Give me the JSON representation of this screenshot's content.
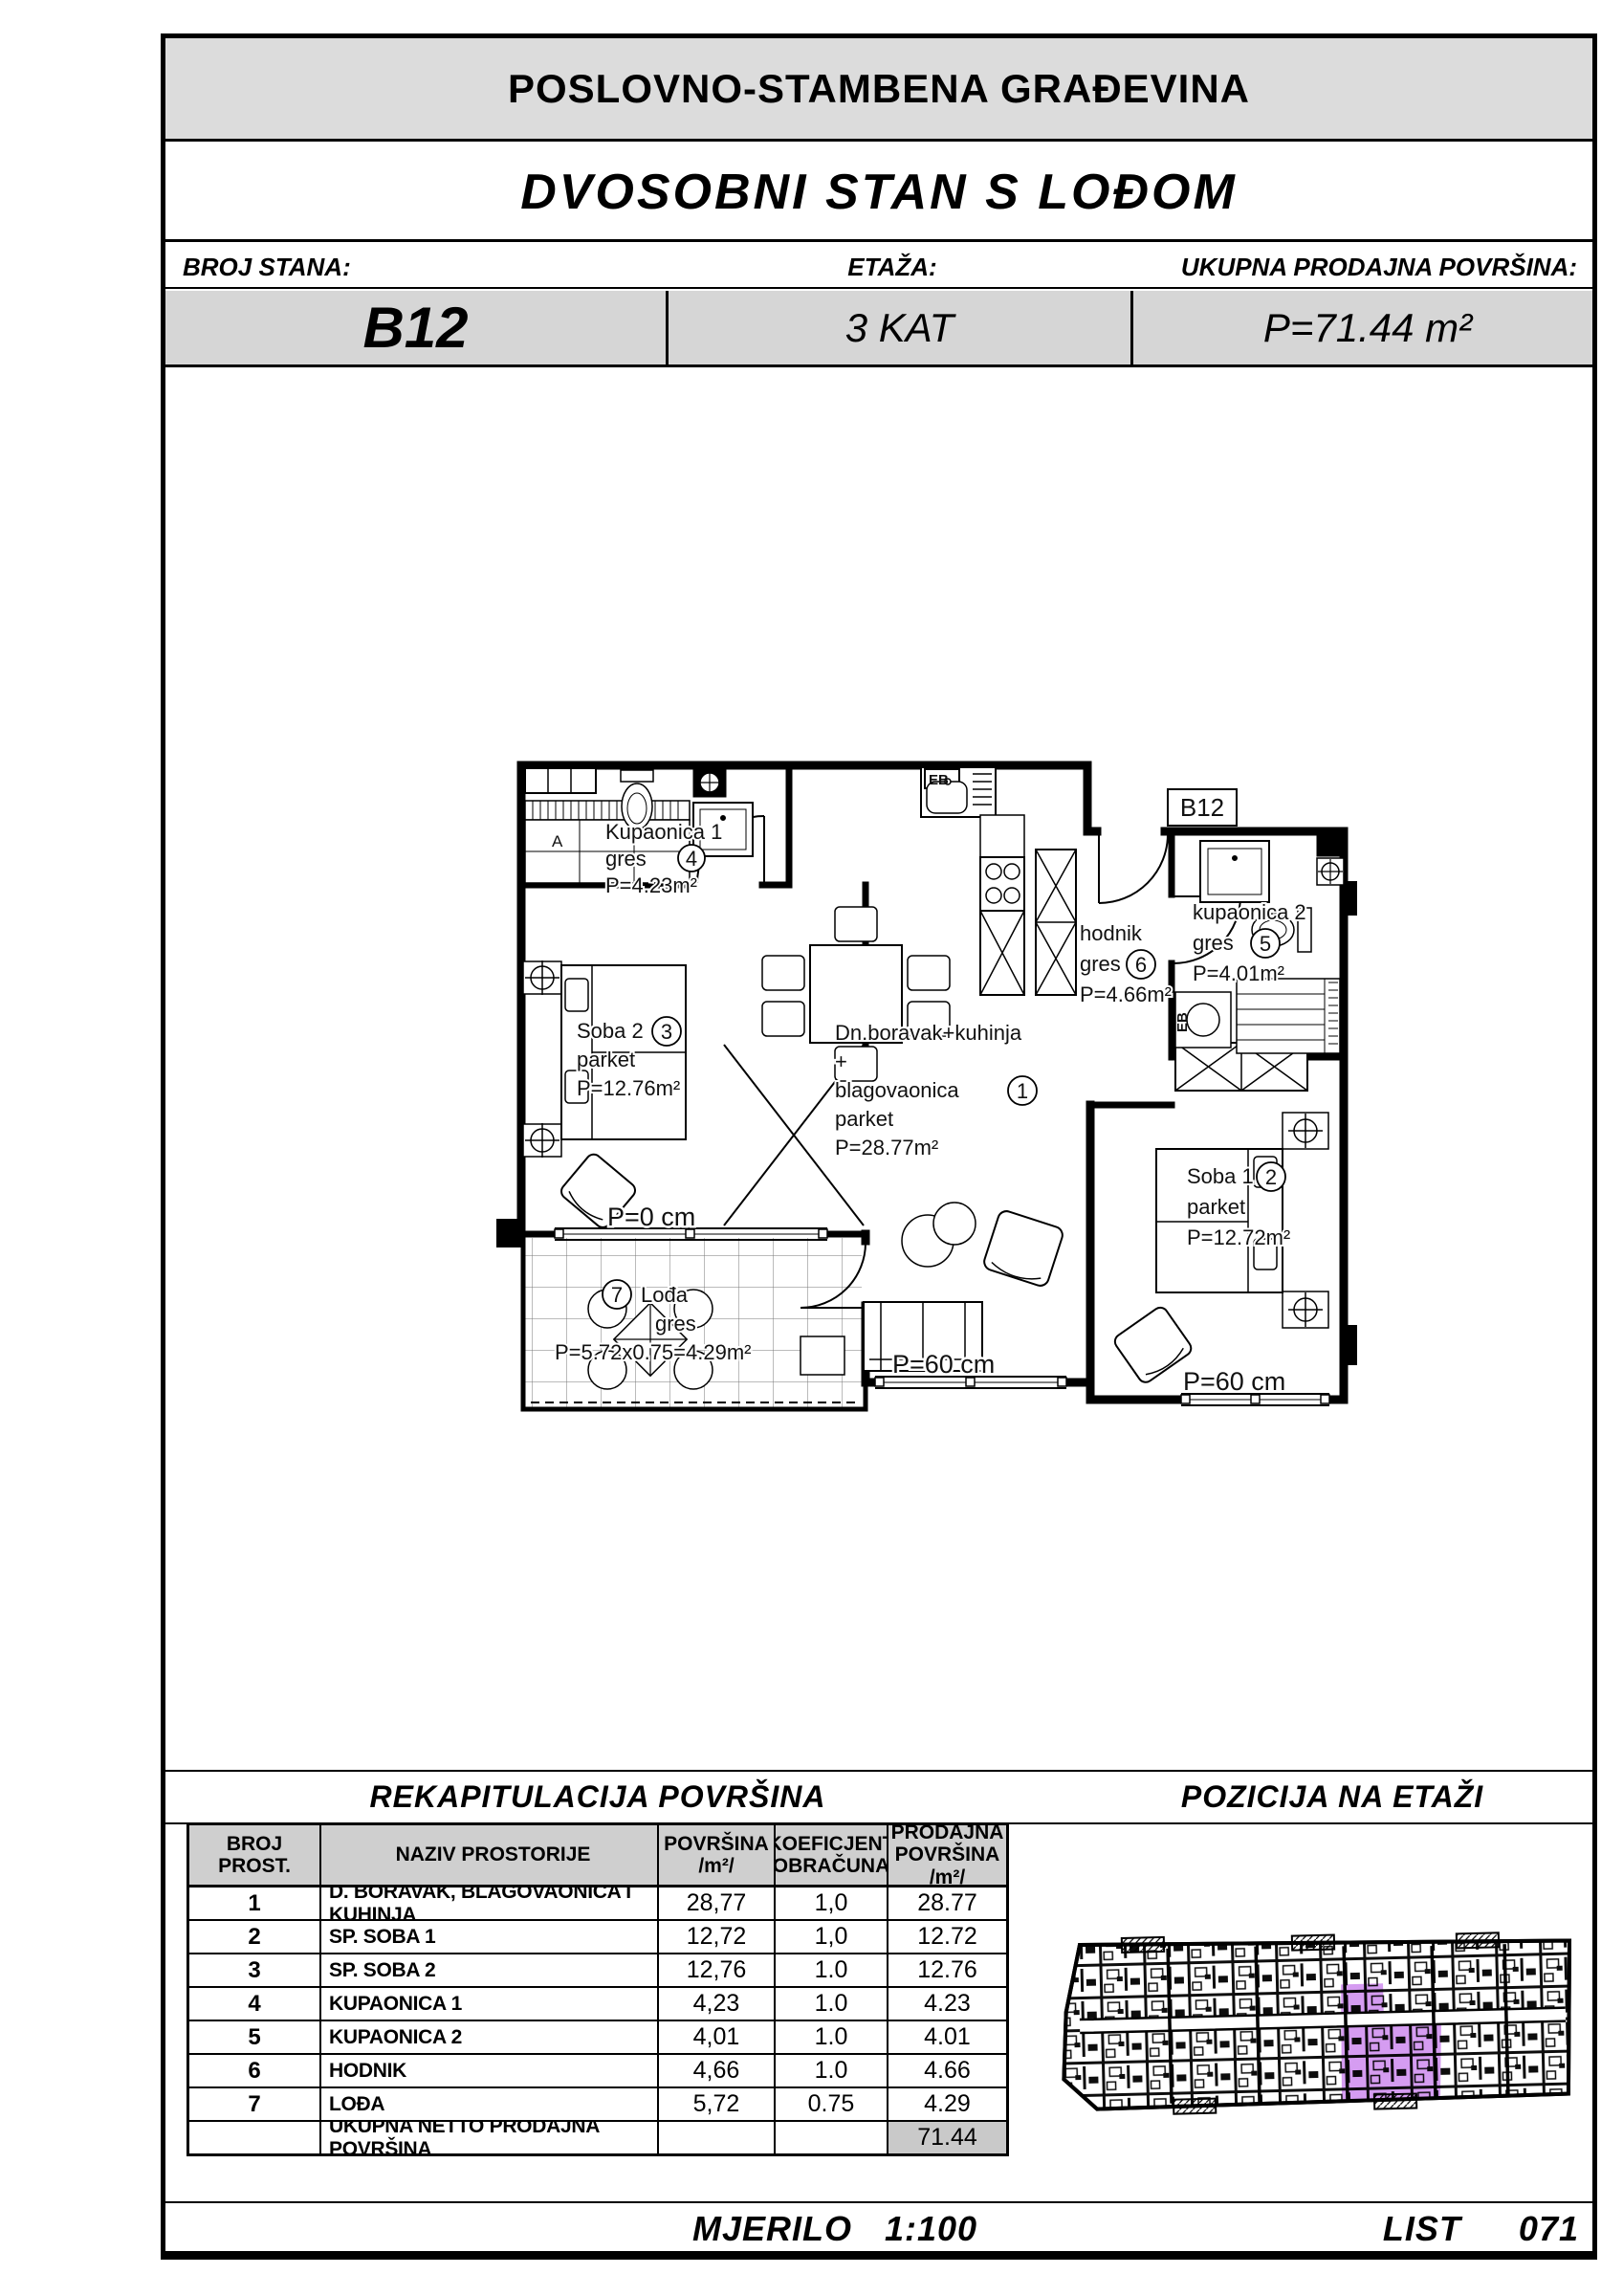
{
  "header": {
    "building_title": "POSLOVNO-STAMBENA GRAĐEVINA",
    "unit_title": "DVOSOBNI STAN S LOĐOM",
    "labels": {
      "broj_stana": "BROJ STANA:",
      "etaza": "ETAŽA:",
      "ukupna": "UKUPNA PRODAJNA POVRŠINA:"
    },
    "values": {
      "broj_stana": "B12",
      "etaza": "3 KAT",
      "ukupna": "P=71.44 m²"
    }
  },
  "plan": {
    "unit_tag": "B12",
    "eb": "EB",
    "a_mark": "A",
    "rooms": {
      "kupaonica1": {
        "name": "Kupaonica 1",
        "floor": "gres",
        "no": "4",
        "area": "P=4.23m²"
      },
      "soba2": {
        "name": "Soba 2",
        "floor": "parket",
        "no": "3",
        "area": "P=12.76m²"
      },
      "living": {
        "l1": "Dn.boravak+kuhinja",
        "l2": "+",
        "l3": "blagovaonica",
        "no": "1",
        "l4": "parket",
        "area": "P=28.77m²"
      },
      "hodnik": {
        "name": "hodnik",
        "floor": "gres",
        "no": "6",
        "area": "P=4.66m²"
      },
      "kupaonica2": {
        "name": "kupaonica 2",
        "floor": "gres",
        "no": "5",
        "area": "P=4.01m²"
      },
      "soba1": {
        "name": "Soba 1",
        "floor": "parket",
        "no": "2",
        "area": "P=12.72m²"
      },
      "lodja": {
        "name": "Lođa",
        "floor": "gres",
        "no": "7",
        "area": "P=5.72x0.75=4.29m²"
      }
    },
    "parapets": {
      "p0": "P=0 cm",
      "p60_living": "P=60 cm",
      "p60_soba1": "P=60 cm"
    }
  },
  "recap": {
    "title": "REKAPITULACIJA POVRŠINA",
    "headers": [
      {
        "l1": "BROJ PROST.",
        "l2": ""
      },
      {
        "l1": "NAZIV PROSTORIJE",
        "l2": ""
      },
      {
        "l1": "POVRŠINA  /m²/",
        "l2": ""
      },
      {
        "l1": "KOEFICJENT",
        "l2": "OBRAČUNA"
      },
      {
        "l1": "PRODAJNA",
        "l2": "POVRŠINA /m²/"
      }
    ],
    "rows": [
      {
        "no": "1",
        "name": "D. BORAVAK, BLAGOVAONICA I KUHINJA",
        "area": "28,77",
        "koef": "1,0",
        "sale": "28.77"
      },
      {
        "no": "2",
        "name": "SP. SOBA 1",
        "area": "12,72",
        "koef": "1,0",
        "sale": "12.72"
      },
      {
        "no": "3",
        "name": "SP. SOBA 2",
        "area": "12,76",
        "koef": "1.0",
        "sale": "12.76"
      },
      {
        "no": "4",
        "name": "KUPAONICA 1",
        "area": "4,23",
        "koef": "1.0",
        "sale": "4.23"
      },
      {
        "no": "5",
        "name": "KUPAONICA 2",
        "area": "4,01",
        "koef": "1.0",
        "sale": "4.01"
      },
      {
        "no": "6",
        "name": "HODNIK",
        "area": "4,66",
        "koef": "1.0",
        "sale": "4.66"
      },
      {
        "no": "7",
        "name": "LOĐA",
        "area": "5,72",
        "koef": "0.75",
        "sale": "4.29"
      }
    ],
    "total_label": "UKUPNA NETTO PRODAJNA POVRŠINA",
    "total_value": "71.44"
  },
  "position": {
    "title": "POZICIJA NA ETAŽI",
    "highlight_color": "#d59cf1"
  },
  "footer": {
    "scale_label": "MJERILO",
    "scale_value": "1:100",
    "sheet_label": "LIST",
    "sheet_value": "071"
  }
}
